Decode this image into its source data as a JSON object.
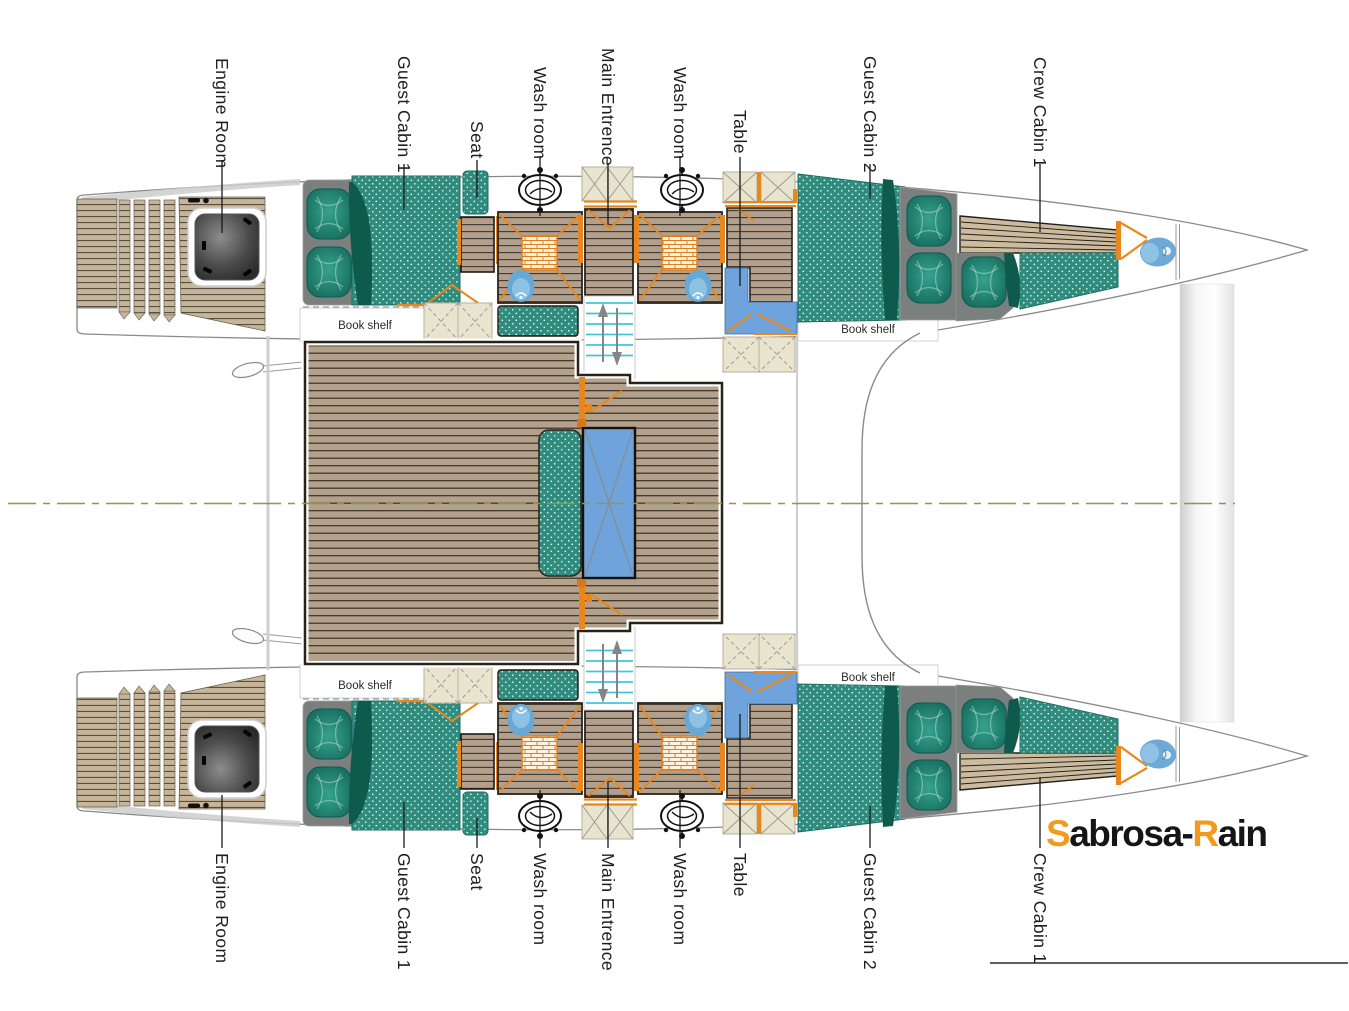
{
  "plan": {
    "book_shelf_label": "Book shelf",
    "logo": {
      "part1": "S",
      "part2": "abrosa-",
      "part3": "R",
      "part4": "ain"
    },
    "labels": {
      "top": [
        {
          "id": "engine-room",
          "text": "Engine Room"
        },
        {
          "id": "guest-cabin-1",
          "text": "Guest Cabin 1"
        },
        {
          "id": "seat",
          "text": "Seat"
        },
        {
          "id": "wash-room-1",
          "text": "Wash room"
        },
        {
          "id": "main-entrence",
          "text": "Main Entrence"
        },
        {
          "id": "wash-room-2",
          "text": "Wash room"
        },
        {
          "id": "table",
          "text": "Table"
        },
        {
          "id": "guest-cabin-2",
          "text": "Guest Cabin 2"
        },
        {
          "id": "crew-cabin-1",
          "text": "Crew Cabin 1"
        }
      ],
      "bottom": [
        {
          "id": "engine-room",
          "text": "Engine Room"
        },
        {
          "id": "guest-cabin-1",
          "text": "Guest Cabin 1"
        },
        {
          "id": "seat",
          "text": "Seat"
        },
        {
          "id": "wash-room-1",
          "text": "Wash room"
        },
        {
          "id": "main-entrence",
          "text": "Main Entrence"
        },
        {
          "id": "wash-room-2",
          "text": "Wash room"
        },
        {
          "id": "table",
          "text": "Table"
        },
        {
          "id": "guest-cabin-2",
          "text": "Guest Cabin 2"
        },
        {
          "id": "crew-cabin-1",
          "text": "Crew Cabin 1"
        }
      ]
    },
    "colors": {
      "wood_floor": "#B2A08C",
      "deck_wood": "#B3A18B",
      "stern_wood": "#C7B59A",
      "mattress_teal": "#2F8C7E",
      "pillow_teal": "#11685A",
      "bed_base_gray": "#7B7F7E",
      "accent_orange": "#E8871E",
      "table_blue": "#6FA3DC",
      "toilet_blue": "#67A8D6",
      "hatch_beige": "#E9E4CE",
      "stairs_cyan": "#3FC6DA",
      "centerline_green": "#8C9A45",
      "logo_orange": "#F29A1D",
      "logo_black": "#151515"
    }
  }
}
